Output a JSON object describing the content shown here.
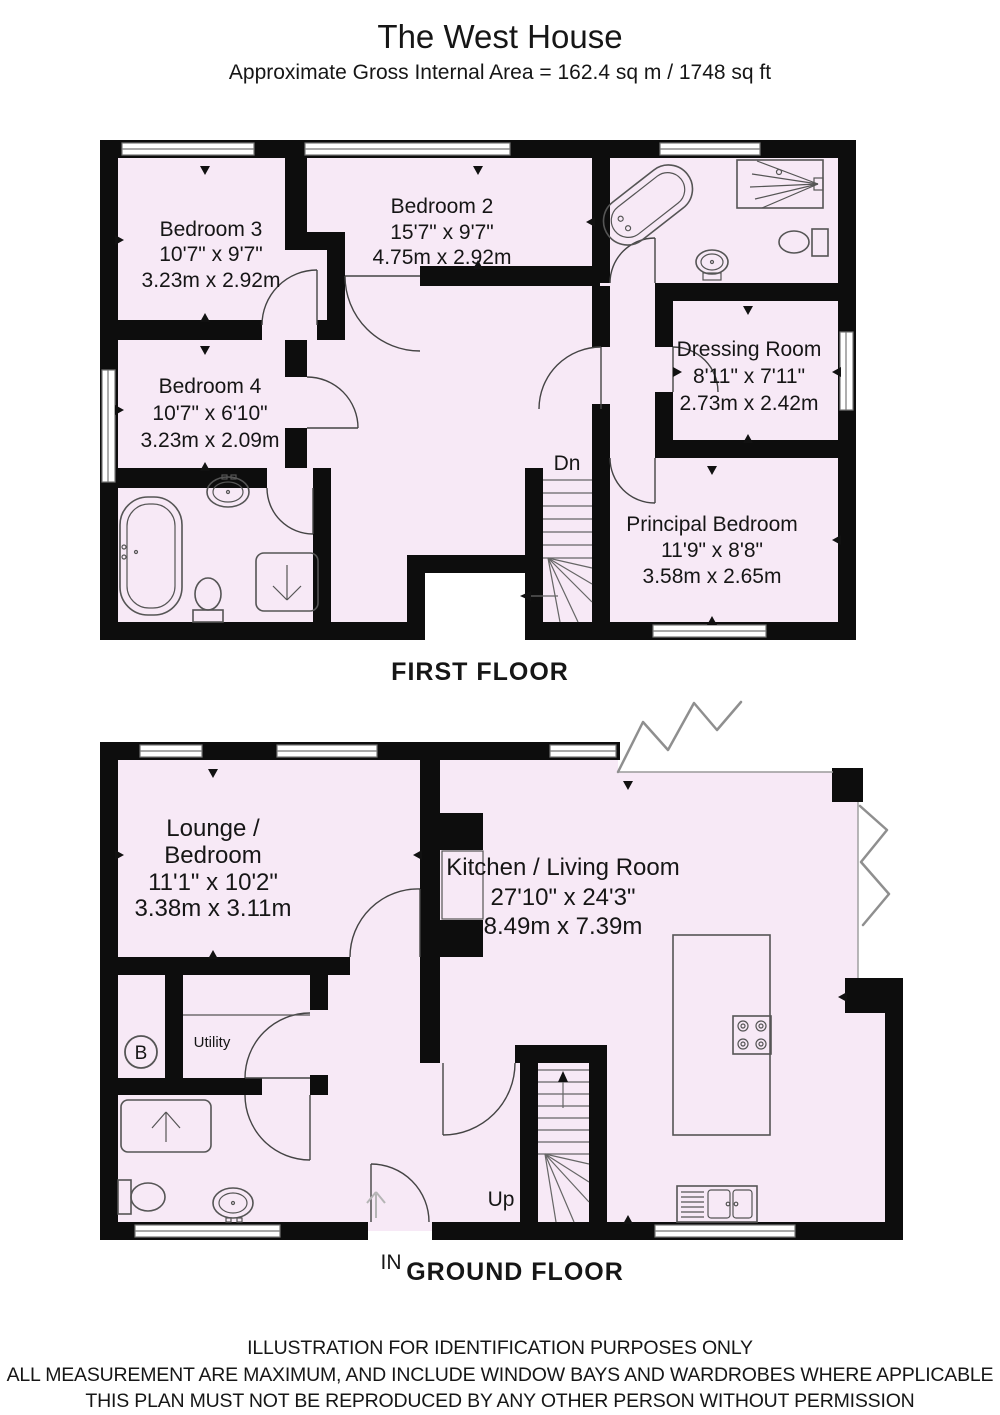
{
  "title": "The West House",
  "subtitle": "Approximate Gross Internal Area = 162.4 sq m / 1748 sq ft",
  "first_floor": {
    "label": "FIRST FLOOR",
    "stairs": "Dn",
    "rooms": {
      "bedroom3": {
        "name": "Bedroom 3",
        "imperial": "10'7\" x 9'7\"",
        "metric": "3.23m x 2.92m"
      },
      "bedroom2": {
        "name": "Bedroom 2",
        "imperial": "15'7\" x 9'7\"",
        "metric": "4.75m x 2.92m"
      },
      "dressing": {
        "name": "Dressing Room",
        "imperial": "8'11\" x 7'11\"",
        "metric": "2.73m x 2.42m"
      },
      "bedroom4": {
        "name": "Bedroom 4",
        "imperial": "10'7\" x 6'10\"",
        "metric": "3.23m x 2.09m"
      },
      "principal": {
        "name": "Principal Bedroom",
        "imperial": "11'9\" x 8'8\"",
        "metric": "3.58m x 2.65m"
      }
    }
  },
  "ground_floor": {
    "label": "GROUND FLOOR",
    "stairs": "Up",
    "entrance": "IN",
    "boiler": "B",
    "rooms": {
      "lounge": {
        "name_line1": "Lounge /",
        "name_line2": "Bedroom",
        "imperial": "11'1\" x 10'2\"",
        "metric": "3.38m x 3.11m"
      },
      "kitchen": {
        "name": "Kitchen / Living Room",
        "imperial": "27'10\" x 24'3\"",
        "metric": "8.49m x 7.39m"
      },
      "utility": {
        "name": "Utility"
      }
    }
  },
  "footer": [
    "ILLUSTRATION FOR IDENTIFICATION PURPOSES ONLY",
    "ALL MEASUREMENT  ARE MAXIMUM, AND INCLUDE WINDOW BAYS AND WARDROBES WHERE APPLICABLE",
    "THIS PLAN MUST NOT BE REPRODUCED BY ANY OTHER PERSON WITHOUT PERMISSION"
  ],
  "colors": {
    "room_fill": "#f7e9f6",
    "wall": "#0d0d0d",
    "fixture_line": "#555555"
  }
}
